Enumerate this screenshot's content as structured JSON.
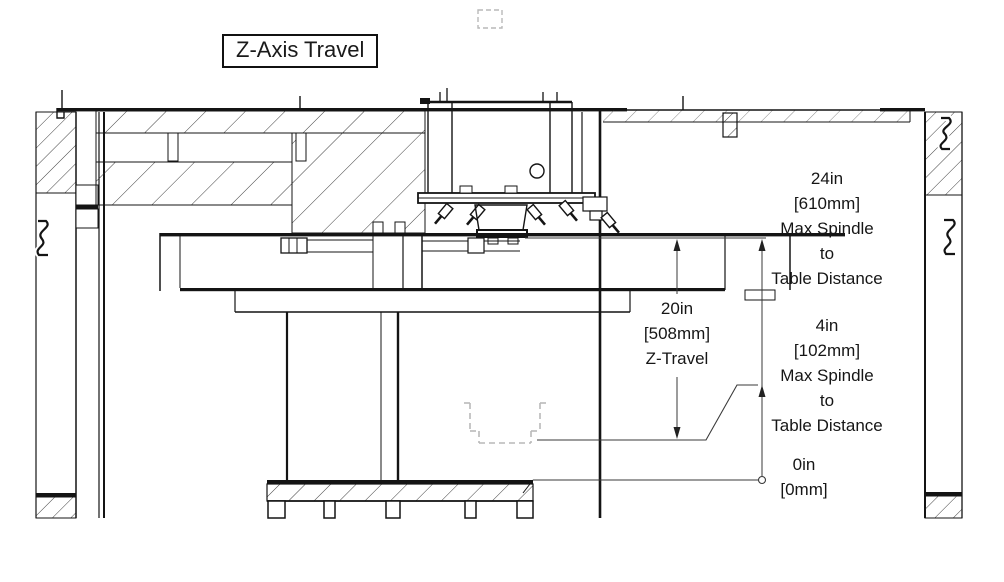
{
  "title": "Z-Axis Travel",
  "drawing_type": "cnc-mill-z-axis-section",
  "annotations": {
    "spindle_max": {
      "inches": "24in",
      "mm": "[610mm]",
      "line1": "Max Spindle",
      "line2": "to",
      "line3": "Table Distance"
    },
    "z_travel": {
      "inches": "20in",
      "mm": "[508mm]",
      "label": "Z-Travel"
    },
    "spindle_min": {
      "inches": "4in",
      "mm": "[102mm]",
      "line1": "Max Spindle",
      "line2": "to",
      "line3": "Table Distance"
    },
    "zero": {
      "inches": "0in",
      "mm": "[0mm]"
    }
  },
  "colors": {
    "line": "#141414",
    "dimension": "#3a3a3a",
    "ghost_dashed": "#b9b9b9",
    "paper": "#ffffff"
  }
}
